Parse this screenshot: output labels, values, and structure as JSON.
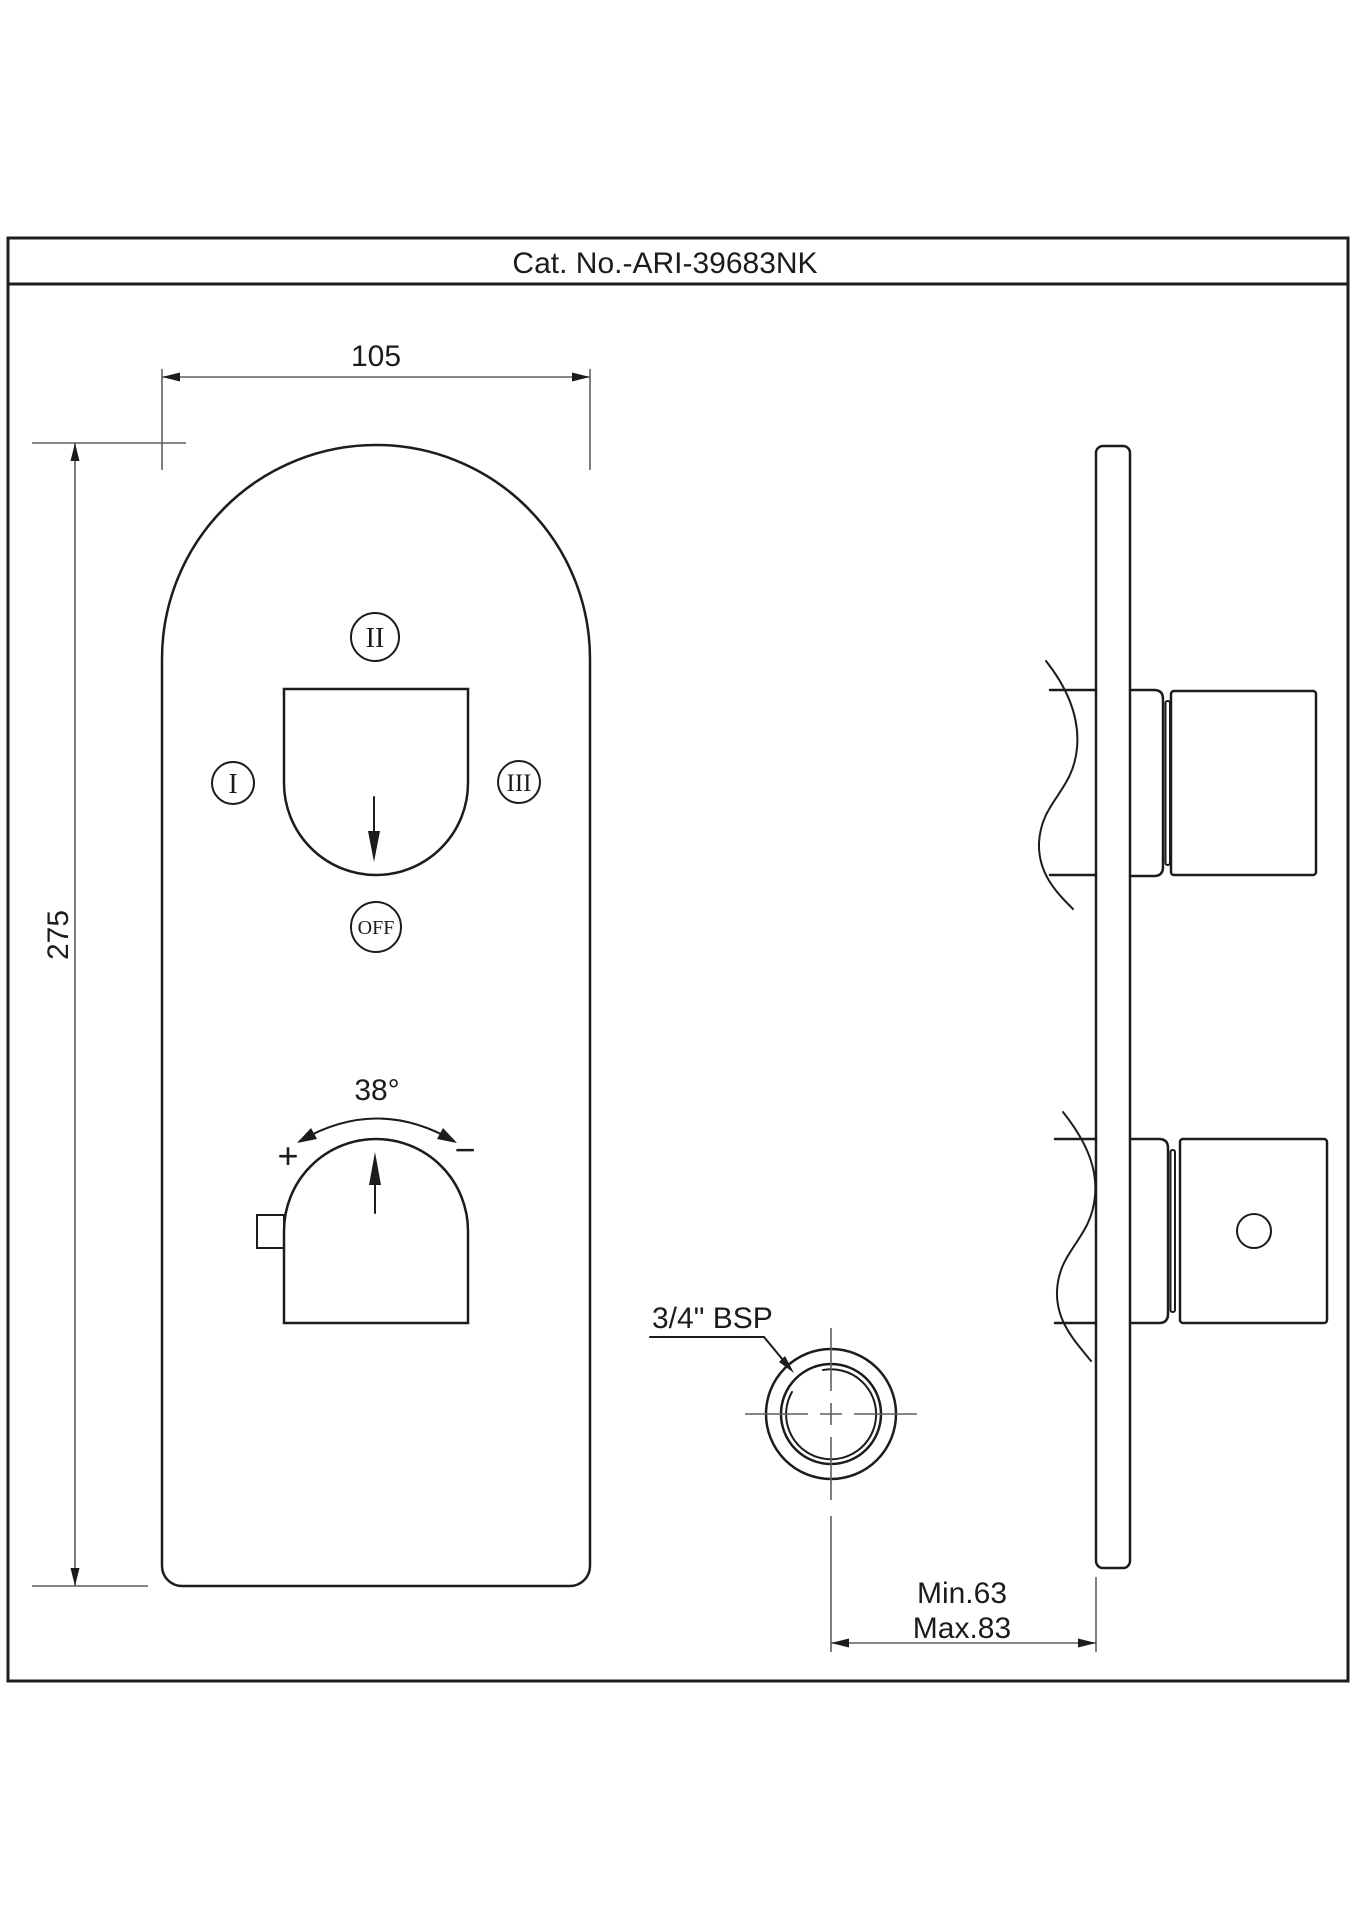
{
  "title_bar": {
    "catalog_number": "Cat. No.-ARI-39683NK"
  },
  "front_view": {
    "width_dim": "105",
    "height_dim": "275",
    "diverter": {
      "position_top": "II",
      "position_left": "I",
      "position_right": "III",
      "position_off": "OFF"
    },
    "temperature": {
      "angle_label": "38°",
      "hot_label": "+",
      "cold_label": "−"
    }
  },
  "connection_detail": {
    "thread_label": "3/4\" BSP"
  },
  "installation_depth": {
    "min_label": "Min.63",
    "max_label": "Max.83"
  },
  "colors": {
    "object_line": "#1c1c1c",
    "dimension_line": "#5f5f5f",
    "background": "#ffffff"
  }
}
